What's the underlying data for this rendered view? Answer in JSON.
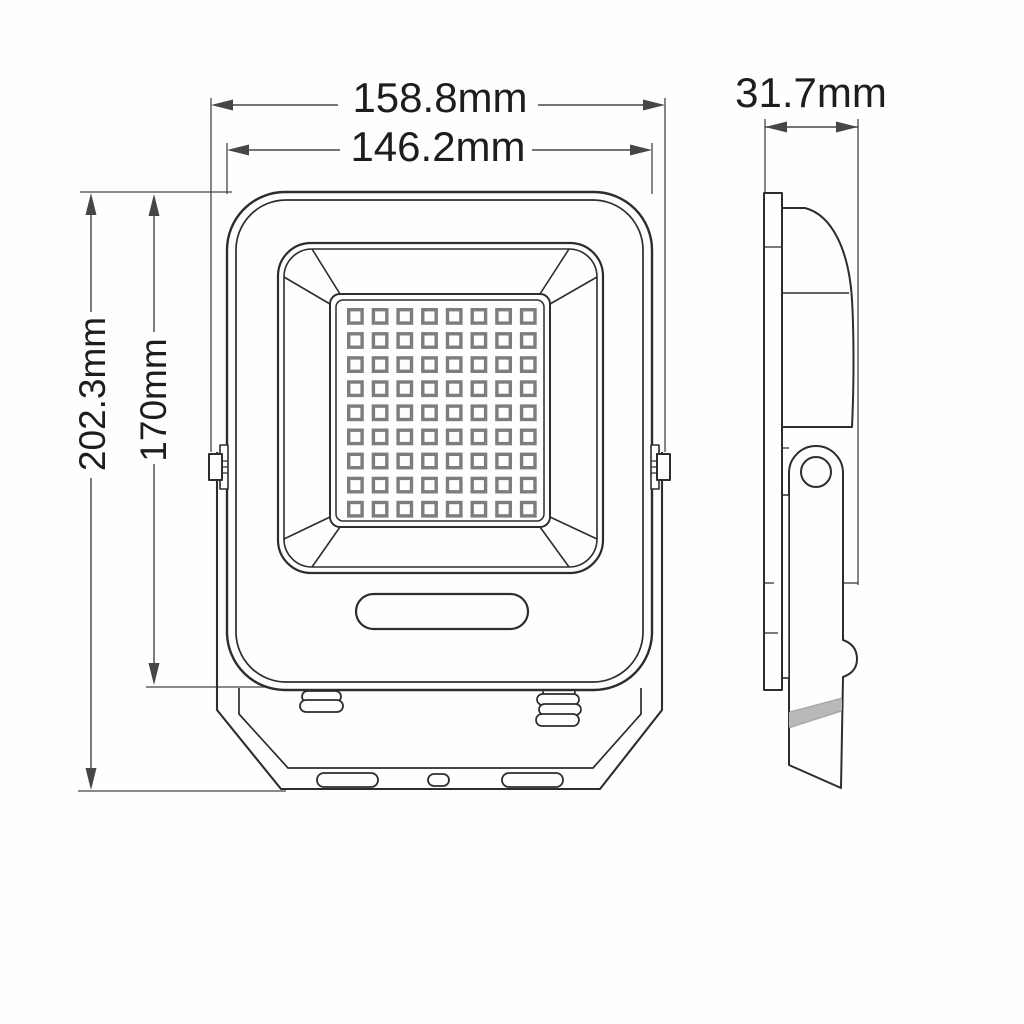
{
  "dimensions": {
    "front_width_overall": "158.8mm",
    "front_width_body": "146.2mm",
    "side_depth": "31.7mm",
    "front_height_overall": "202.3mm",
    "front_height_body": "170mm"
  },
  "front_view": {
    "led_grid": {
      "rows": 9,
      "cols": 8
    }
  },
  "colors": {
    "line": "#2d2d2d",
    "dim-line": "#464646",
    "led-line": "#7d7d7d",
    "text": "#1d1d1d",
    "stripe": "#b9b9b9",
    "background": "#fefefe"
  }
}
